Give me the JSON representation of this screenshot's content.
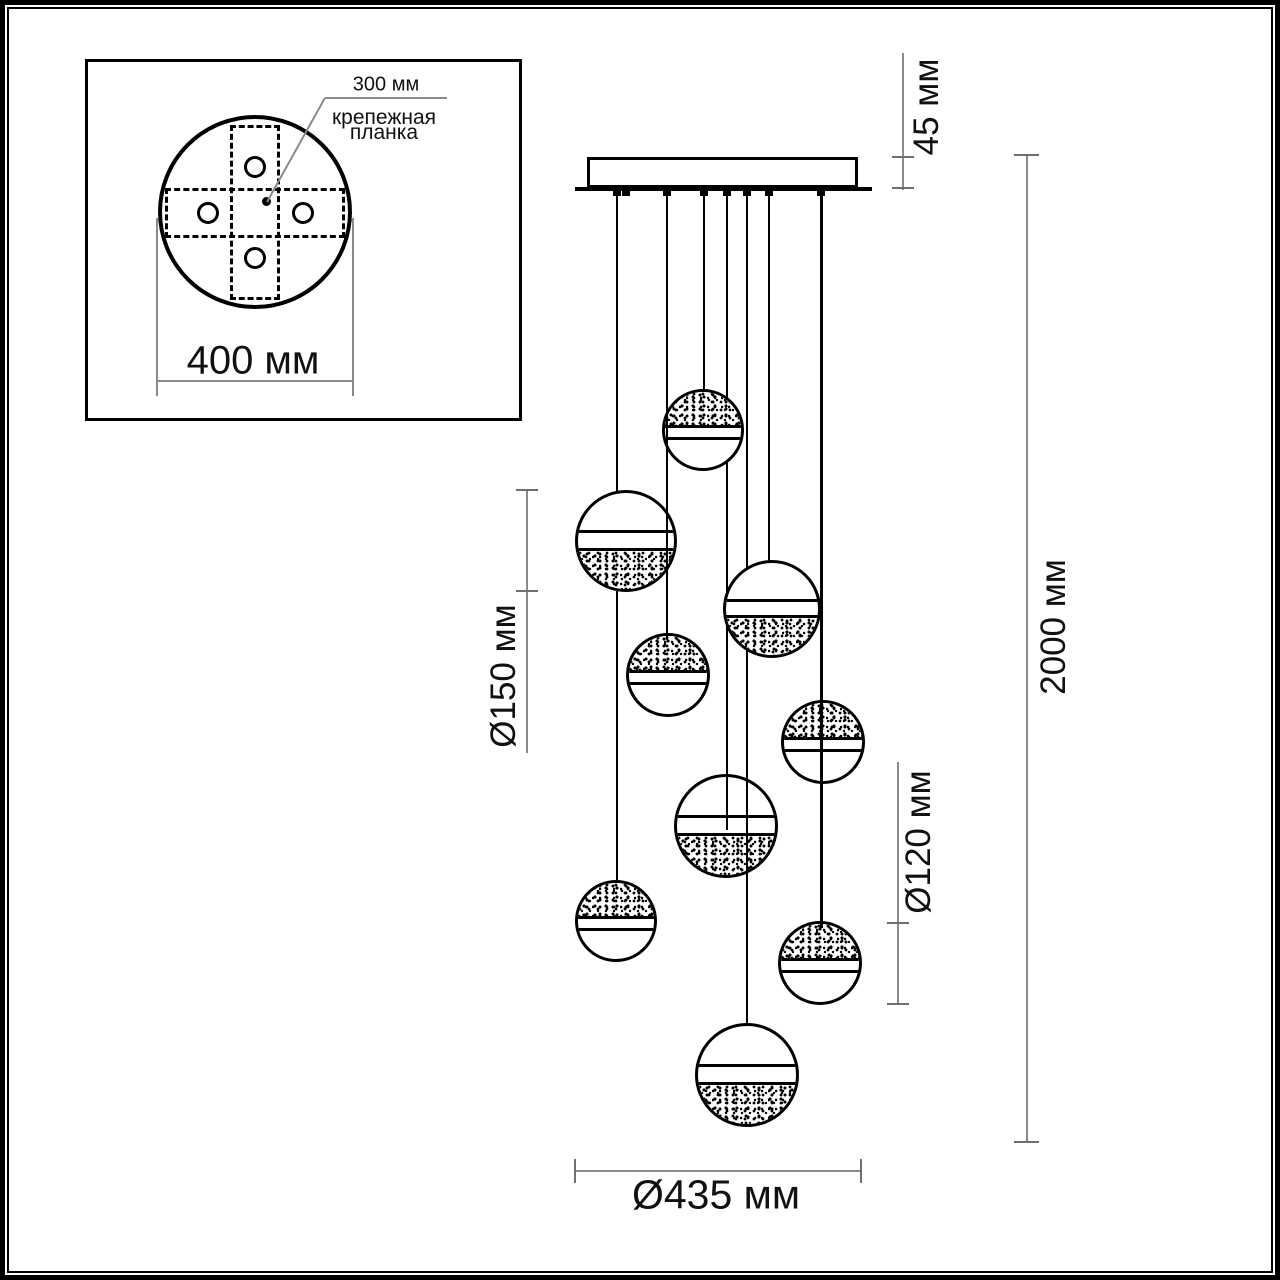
{
  "title": "pendant chandelier dimensional drawing",
  "colors": {
    "ink": "#000000",
    "dim_line": "#8a8a8a",
    "text": "#111111",
    "background": "#ffffff"
  },
  "inset": {
    "bracket_size_label": "300 мм",
    "bracket_caption_line1": "крепежная",
    "bracket_caption_line2": "планка",
    "plate_diameter_label": "400 мм"
  },
  "dims": {
    "canopy_height": "45 мм",
    "overall_drop": "2000 мм",
    "large_sphere": "Ø150 мм",
    "small_sphere": "Ø120 мм",
    "spread": "Ø435 мм"
  },
  "drawing": {
    "canopy": {
      "x": 587,
      "y": 157,
      "w": 271,
      "h": 31,
      "base_x": 575,
      "base_y": 187,
      "base_w": 297,
      "base_h": 4
    },
    "band": {
      "top": {
        "l1": 0.44,
        "l2": 0.59
      },
      "bottom": {
        "l1": 0.39,
        "l2": 0.57
      }
    },
    "spheres": [
      {
        "cx": 703,
        "cy": 430,
        "r": 41,
        "texture": "top"
      },
      {
        "cx": 626,
        "cy": 541,
        "r": 51,
        "texture": "bottom"
      },
      {
        "cx": 772,
        "cy": 609,
        "r": 49,
        "texture": "bottom"
      },
      {
        "cx": 668,
        "cy": 675,
        "r": 42,
        "texture": "top"
      },
      {
        "cx": 823,
        "cy": 742,
        "r": 42,
        "texture": "top"
      },
      {
        "cx": 726,
        "cy": 826,
        "r": 52,
        "texture": "bottom"
      },
      {
        "cx": 616,
        "cy": 921,
        "r": 41,
        "texture": "top"
      },
      {
        "cx": 820,
        "cy": 963,
        "r": 42,
        "texture": "top"
      },
      {
        "cx": 747,
        "cy": 1075,
        "r": 52,
        "texture": "bottom"
      }
    ],
    "cords": [
      {
        "x": 704,
        "y1": 190,
        "y2": 395,
        "w": 2,
        "layer": "base"
      },
      {
        "x": 617,
        "y1": 190,
        "y2": 496,
        "w": 2,
        "layer": "base"
      },
      {
        "x": 769,
        "y1": 190,
        "y2": 566,
        "w": 2,
        "layer": "base"
      },
      {
        "x": 727,
        "y1": 190,
        "y2": 781,
        "w": 2,
        "layer": "base"
      },
      {
        "x": 617,
        "y1": 190,
        "y2": 886,
        "w": 2,
        "layer": "base"
      },
      {
        "x": 821,
        "y1": 190,
        "y2": 707,
        "w": 3,
        "layer": "base"
      },
      {
        "x": 747,
        "y1": 190,
        "y2": 1030,
        "w": 2,
        "layer": "base"
      },
      {
        "x": 667,
        "y1": 190,
        "y2": 640,
        "w": 2,
        "layer": "over"
      },
      {
        "x": 727,
        "y1": 775,
        "y2": 830,
        "w": 2,
        "layer": "over"
      },
      {
        "x": 821,
        "y1": 701,
        "y2": 928,
        "w": 3,
        "layer": "over"
      },
      {
        "x": 747,
        "y1": 775,
        "y2": 1024,
        "w": 2,
        "layer": "over"
      }
    ],
    "nubs": [
      617,
      626,
      667,
      704,
      727,
      747,
      769,
      821
    ]
  }
}
